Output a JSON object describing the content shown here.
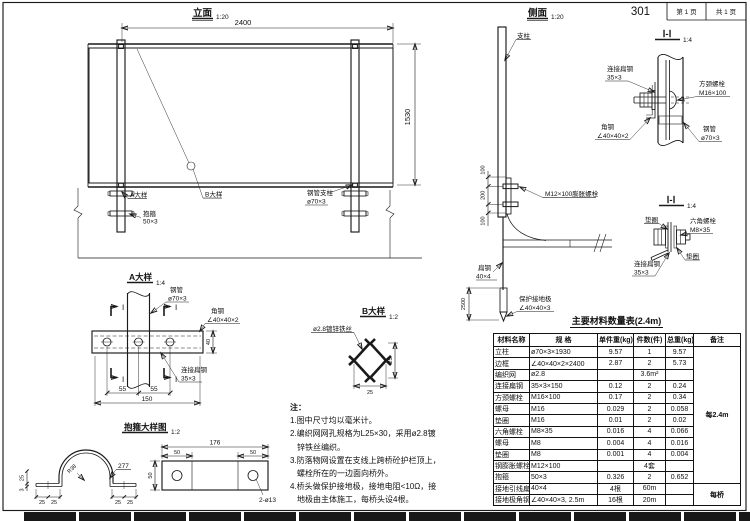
{
  "sheet": {
    "number": "301",
    "page": "第 1 页",
    "pages_total": "共 1 页"
  },
  "elevation": {
    "title": "立面",
    "scale": "1:20",
    "dim_width": "2400",
    "dim_height": "1530",
    "label_detail_a": "A大样",
    "label_hoop": "抱箍",
    "label_hoop_spec": "50×3",
    "label_detail_b": "B大样",
    "label_post": "钢管支柱",
    "label_post_spec": "ø70×3"
  },
  "side": {
    "title": "侧面",
    "scale": "1:20",
    "label_post": "支柱",
    "label_anchor_bolt": "M12×100膨胀螺栓",
    "dim_100a": "100",
    "dim_200": "200",
    "dim_100b": "100",
    "dim_2500": "2500",
    "label_flat": "扁钢",
    "label_flat_spec": "40×4",
    "label_rod": "保护接地极",
    "label_rod_spec": "∠40×40×3"
  },
  "section1": {
    "title": "Ⅰ-Ⅰ",
    "scale": "1:4",
    "label_strip": "连接扁钢",
    "label_strip_spec": "35×3",
    "label_bolt": "方颈螺栓",
    "label_bolt_spec": "M16×100",
    "label_angle": "角钢",
    "label_angle_spec": "∠40×40×2",
    "label_pipe": "钢管",
    "label_pipe_spec": "ø70×3"
  },
  "section2": {
    "title": "Ⅰ-Ⅰ",
    "scale": "1:4",
    "label_washer_top": "垫圈",
    "label_bolt": "六角螺栓",
    "label_bolt_spec": "M8×35",
    "label_washer_bottom": "垫圈",
    "label_strip": "连接扁钢",
    "label_strip_spec": "35×3"
  },
  "detail_a": {
    "title": "A大样",
    "scale": "1:4",
    "label_pipe": "钢管",
    "label_pipe_spec": "ø70×3",
    "label_angle": "角钢",
    "label_angle_spec": "∠40×40×2",
    "label_strip": "连接扁钢",
    "label_strip_spec": "35×3",
    "mark": "Ⅰ",
    "dim_55a": "55",
    "dim_55b": "55",
    "dim_150": "150",
    "dim_40": "40"
  },
  "detail_b": {
    "title": "B大样",
    "scale": "1:2",
    "label_wire": "ø2.8镀锌铁丝",
    "dim_h": "25",
    "dim_w": "25"
  },
  "hoop": {
    "title": "抱箍大样图",
    "scale": "1:2",
    "label_radius": "R38",
    "label_length": "277",
    "label_holes": "2-ø13",
    "dim_176": "176",
    "dim_50a": "50",
    "dim_50b": "50",
    "dim_50h": "50",
    "dim_25a": "25",
    "dim_25b": "25",
    "dim_25c": "25",
    "dim_25d": "25",
    "dim_side_25": "25",
    "dim_side_3": "3"
  },
  "notes": {
    "title": "注：",
    "lines": [
      "1.图中尺寸均以毫米计。",
      "2.编织网网孔规格为L25×30，采用ø2.8镀",
      "锌铁丝编织。",
      "3.防落物网设置在支线上跨桥砼护栏顶上，",
      "螺栓所在的一边面向桥外。",
      "4.桥头做保护接地极，接地电阻<10Ω，接",
      "地极由主体施工，每桥头设4根。"
    ]
  },
  "materials": {
    "title": "主要材料数量表(2.4m)",
    "headers": [
      "材料名称",
      "规  格",
      "单件重(kg)",
      "件数(件)",
      "总重(kg)",
      "备注"
    ],
    "rows": [
      [
        "立柱",
        "ø70×3×1930",
        "9.57",
        "1",
        "9.57"
      ],
      [
        "边框",
        "∠40×40×2×2400",
        "2.87",
        "2",
        "5.73"
      ],
      [
        "编织网",
        "ø2.8",
        "",
        "3.6m²",
        ""
      ],
      [
        "连接扁钢",
        "35×3×150",
        "0.12",
        "2",
        "0.24"
      ],
      [
        "方颈螺栓",
        "M16×100",
        "0.17",
        "2",
        "0.34"
      ],
      [
        "螺母",
        "M16",
        "0.029",
        "2",
        "0.058"
      ],
      [
        "垫圈",
        "M16",
        "0.01",
        "2",
        "0.02"
      ],
      [
        "六角螺栓",
        "M8×35",
        "0.016",
        "4",
        "0.066"
      ],
      [
        "螺母",
        "M8",
        "0.004",
        "4",
        "0.016"
      ],
      [
        "垫圈",
        "M8",
        "0.001",
        "4",
        "0.004"
      ],
      [
        "钢膨胀螺栓",
        "M12×100",
        "",
        "4套",
        ""
      ],
      [
        "抱箍",
        "50×3",
        "0.326",
        "2",
        "0.652"
      ],
      [
        "接地引线扁钢",
        "40×4",
        "4根",
        "60m",
        ""
      ],
      [
        "接地极角钢",
        "∠40×40×3, 2.5m",
        "16根",
        "20m",
        ""
      ]
    ],
    "remark_group1": "每2.4m",
    "remark_group2": "每桥"
  }
}
